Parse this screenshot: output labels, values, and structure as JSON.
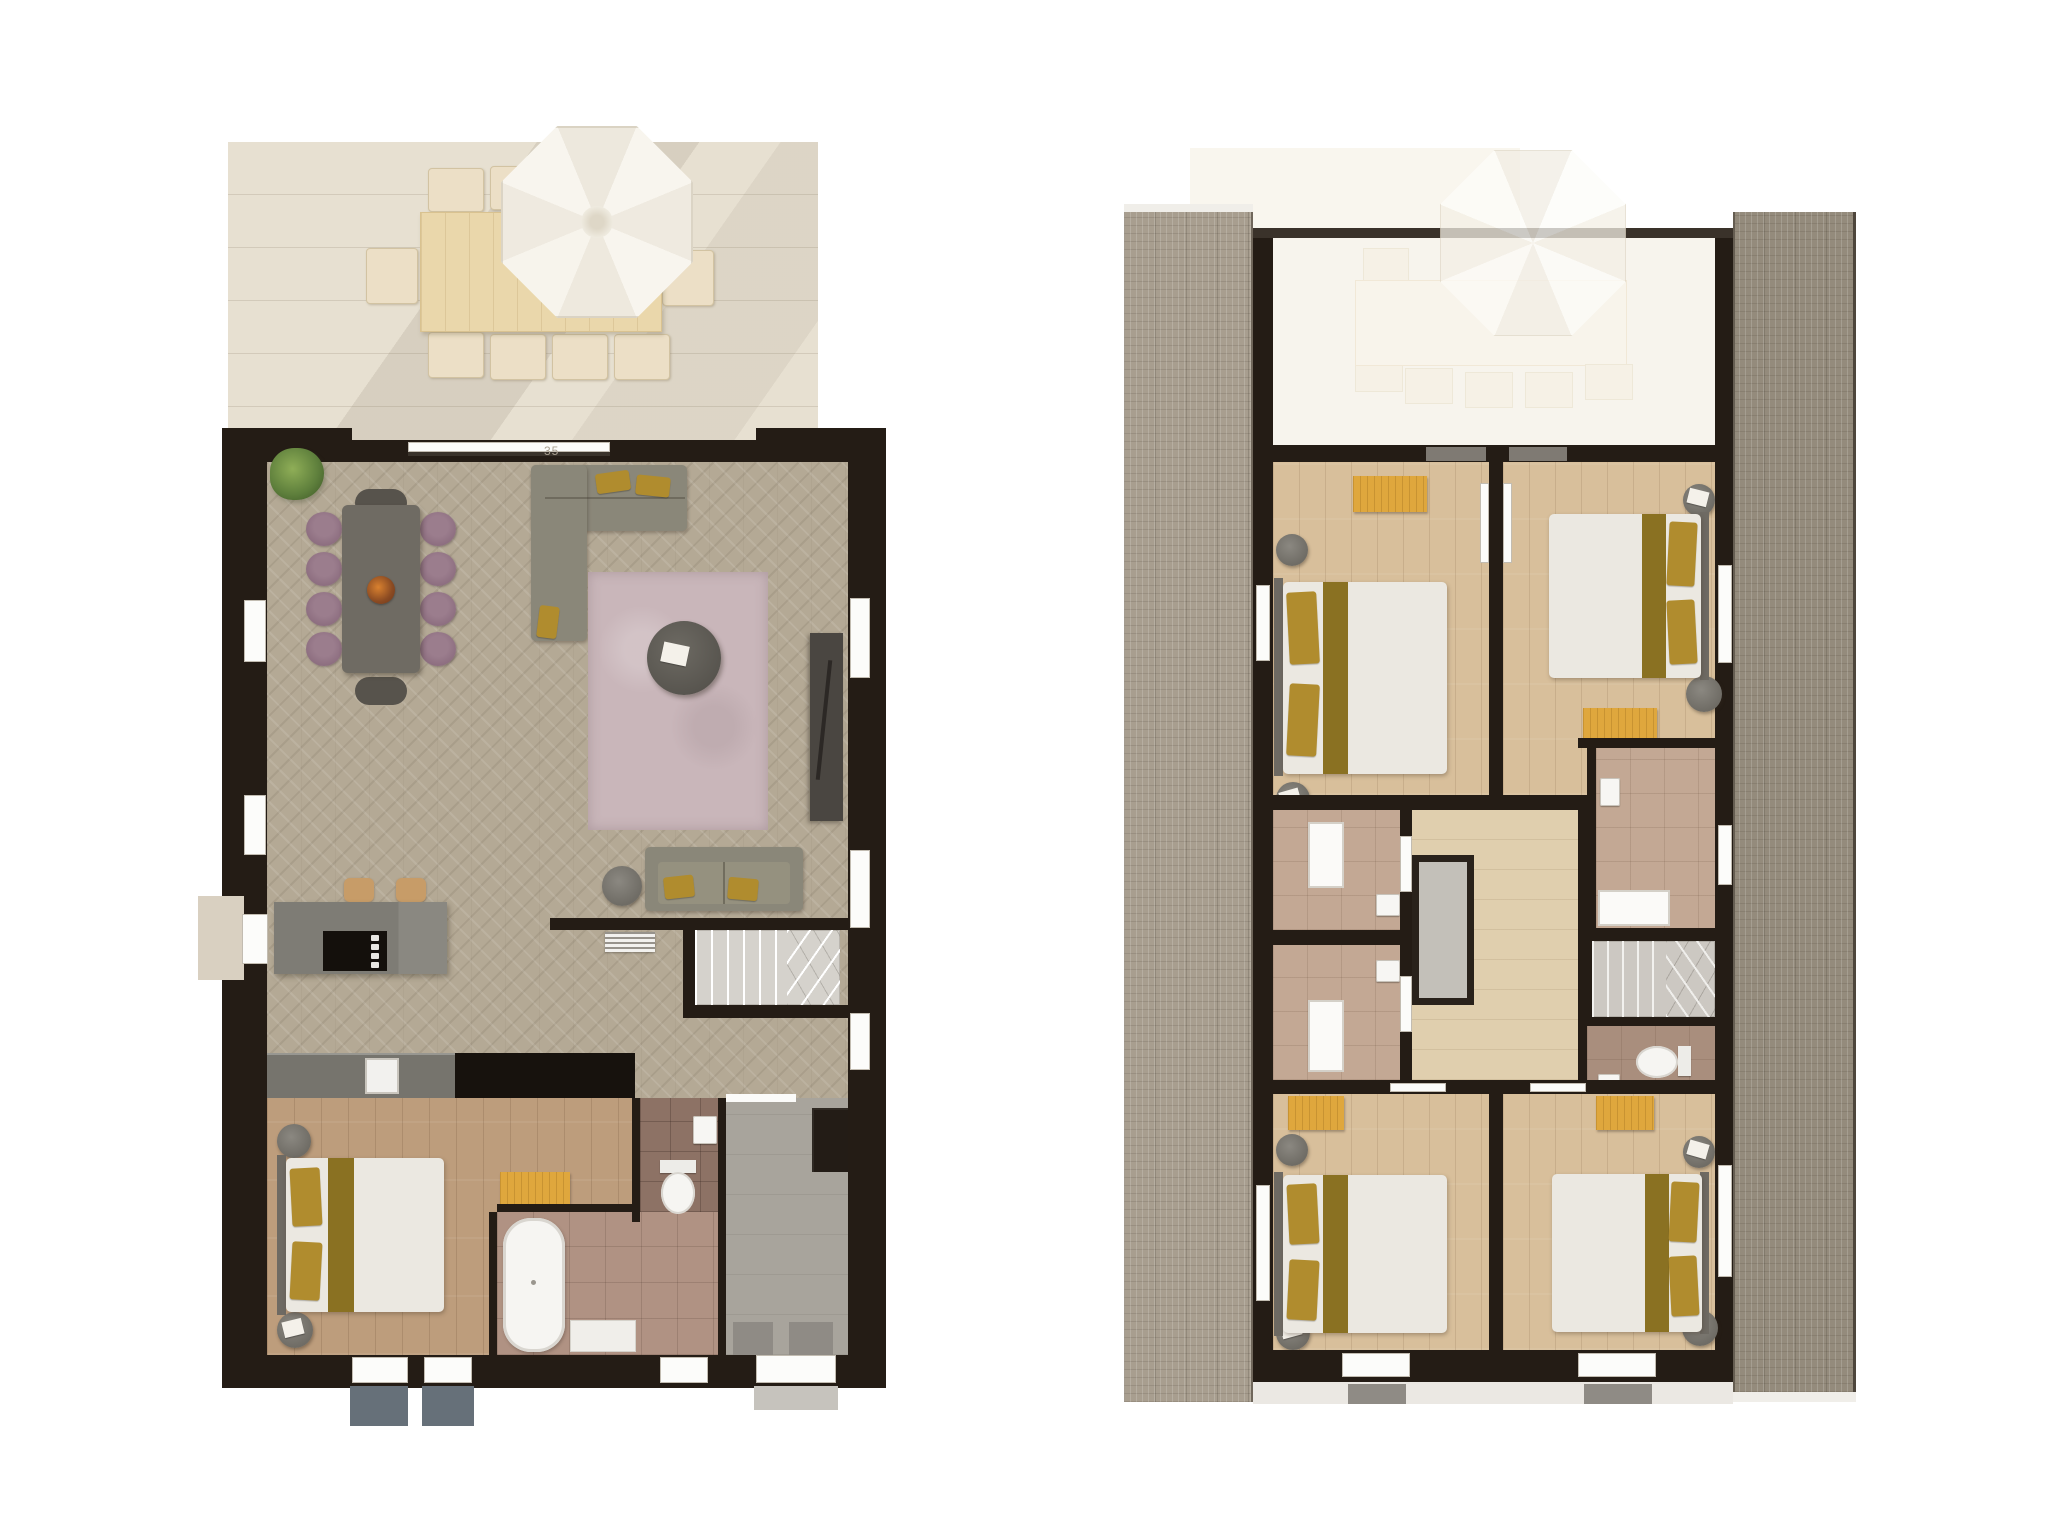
{
  "page": {
    "type": "architectural-floor-plan-render",
    "background": "#ffffff",
    "views": 2
  },
  "annotations": {
    "dimension_label": "35"
  },
  "palette": {
    "wall": "#241c15",
    "herringbone_floor": "#b4a995",
    "plank_floor_ground": "#bd9d7c",
    "plank_floor_upper": "#d8bf9b",
    "landing_floor": "#e0cfae",
    "terrace": "#e7e0d1",
    "parasol": "#f6f2ea",
    "rug": "#c9b6ba",
    "sofa": "#8a8779",
    "mustard_accent": "#c5932f",
    "purple_chair": "#8d6e80",
    "dining_table": "#6f6b63",
    "kitchen_island": "#7e7c75",
    "bench": "#dfa73d",
    "duvet": "#ebe8e1",
    "bed_runner": "#8a7122",
    "pillow": "#b08c2e",
    "bath_tile": "#b09283",
    "wc_tile": "#8d7265",
    "upper_tile": "#c3a894",
    "entrance_hall": "#a8a49c",
    "roof_left": "#a89e8f",
    "roof_right": "#948b7c",
    "stairs": "#d2cfc9",
    "void_opening": "#c3c0b9"
  },
  "plans": [
    {
      "name": "ground-floor",
      "position": "left",
      "outdoor": {
        "areas": [
          "terrace"
        ],
        "furniture": [
          "outdoor-dining-table",
          "outdoor-chairs",
          "parasol"
        ]
      },
      "rooms": [
        {
          "name": "living-dining-room",
          "floor": "herringbone-parquet",
          "furniture": [
            "dining-table",
            "purple-dining-chairs",
            "end-chairs",
            "plant",
            "corner-sofa",
            "rug",
            "coffee-table",
            "magazine",
            "tv-sideboard",
            "loveseat",
            "side-table",
            "radiator"
          ]
        },
        {
          "name": "kitchen",
          "furniture": [
            "island-with-hob",
            "bar-stools",
            "counter-with-sink"
          ]
        },
        {
          "name": "staircase",
          "furniture": [
            "straight-flight",
            "winder-steps"
          ]
        },
        {
          "name": "bedroom",
          "furniture": [
            "double-bed",
            "bedside-tables",
            "bench"
          ]
        },
        {
          "name": "bathroom",
          "furniture": [
            "freestanding-bathtub",
            "bath-mat"
          ]
        },
        {
          "name": "toilet",
          "furniture": [
            "wc",
            "hand-basin"
          ]
        },
        {
          "name": "entrance-hall",
          "furniture": [
            "wardrobe",
            "doormats"
          ]
        }
      ]
    },
    {
      "name": "first-floor",
      "position": "right",
      "outdoor": {
        "areas": [
          "roof-slope-left",
          "roof-slope-right",
          "terrace-below-ghosted"
        ]
      },
      "rooms": [
        {
          "name": "bedroom-front-left",
          "furniture": [
            "double-bed",
            "bench",
            "bedside-tables"
          ]
        },
        {
          "name": "bedroom-front-right",
          "furniture": [
            "double-bed",
            "bench",
            "bedside-tables",
            "washbasin-nook"
          ]
        },
        {
          "name": "shower-room-upper-left",
          "furniture": [
            "shower-tray",
            "washbasin"
          ]
        },
        {
          "name": "shower-room-lower-left",
          "furniture": [
            "shower-tray",
            "washbasin"
          ]
        },
        {
          "name": "landing",
          "furniture": [
            "void-opening"
          ]
        },
        {
          "name": "bathroom-right",
          "furniture": [
            "shower-tray",
            "washbasin"
          ]
        },
        {
          "name": "staircase",
          "furniture": [
            "straight-flight",
            "winder-steps"
          ]
        },
        {
          "name": "toilet",
          "furniture": [
            "wc",
            "hand-basin"
          ]
        },
        {
          "name": "bedroom-back-left",
          "furniture": [
            "double-bed",
            "bench",
            "bedside-tables"
          ]
        },
        {
          "name": "bedroom-back-right",
          "furniture": [
            "double-bed",
            "bench",
            "bedside-tables"
          ]
        }
      ]
    }
  ]
}
